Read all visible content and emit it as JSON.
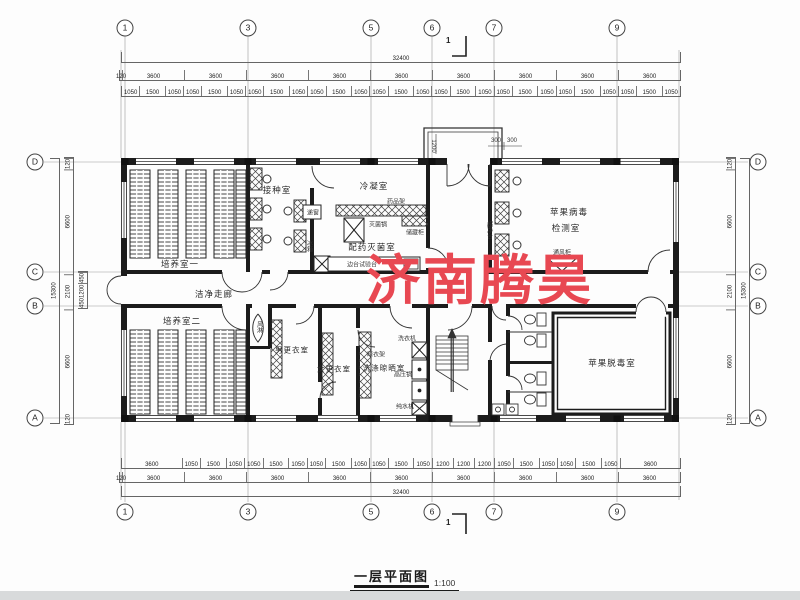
{
  "watermark": {
    "text": "济南腾昊",
    "color": "#e84852"
  },
  "title": {
    "text": "一层平面图",
    "scale": "1:100"
  },
  "section_marks": {
    "top": "1",
    "bottom": "1"
  },
  "axes": {
    "top": [
      "1",
      "3",
      "5",
      "6",
      "7",
      "9"
    ],
    "bottom": [
      "1",
      "3",
      "5",
      "6",
      "7",
      "9"
    ],
    "left": [
      "D",
      "C",
      "B",
      "A"
    ],
    "right": [
      "D",
      "C",
      "B",
      "A"
    ]
  },
  "dims": {
    "top_overall": [
      "32400"
    ],
    "top_bays": [
      "120",
      "3600",
      "3600",
      "3600",
      "3600",
      "3600",
      "3600",
      "3600",
      "3600",
      "3600"
    ],
    "top_fine": [
      "1050",
      "1500",
      "1050",
      "1050",
      "1500",
      "1050",
      "1050",
      "1500",
      "1050",
      "1050",
      "1500",
      "1050",
      "1050",
      "1500",
      "1050",
      "1050",
      "1500",
      "1050",
      "1050",
      "1500",
      "1050",
      "1050",
      "1500",
      "1050",
      "1050",
      "1500",
      "1050"
    ],
    "bottom_fine": [
      "3600",
      "1050",
      "1500",
      "1050",
      "1050",
      "1500",
      "1050",
      "1050",
      "1500",
      "1050",
      "1050",
      "1500",
      "1050",
      "1200",
      "1200",
      "1200",
      "1050",
      "1500",
      "1050",
      "1050",
      "1500",
      "1050",
      "3600"
    ],
    "bottom_bays": [
      "120",
      "3600",
      "3600",
      "3600",
      "3600",
      "3600",
      "3600",
      "3600",
      "3600",
      "3600"
    ],
    "bottom_overall": [
      "32400"
    ],
    "left_overall": [
      "15300"
    ],
    "left_segs": [
      "120",
      "6600",
      "2100",
      "6600",
      "120"
    ],
    "left_sub": [
      "450",
      "1200",
      "450"
    ],
    "right_overall": [
      "15300"
    ],
    "right_segs": [
      "120",
      "6600",
      "2100",
      "6600",
      "120"
    ],
    "porch": {
      "w": "1200",
      "a": "300",
      "b": "300"
    }
  },
  "rooms": {
    "py1": "培养室一",
    "jz": "接种室",
    "ln": "冷凝室",
    "pymj": "配药灭菌室",
    "bd1": "苹果病毒",
    "bd2": "检测室",
    "zou": "洁净走廊",
    "py2": "培养室二",
    "fl": "风淋",
    "ngy": "男更衣室",
    "ngy2": "女更衣室",
    "xd": "洗涤晾晒室",
    "td": "苹果脱毒室"
  },
  "equipment": {
    "dc": "递窗",
    "ypj": "药品架",
    "mjg": "灭菌锅",
    "ccg": "储藏柜",
    "bx": "冰箱",
    "bt": "边台试验台",
    "cjt": "超净台",
    "tfg": "通风柜",
    "xyj": "洗衣机",
    "gyg": "高压锅",
    "csj": "纯水机",
    "lyj": "晾衣架"
  }
}
